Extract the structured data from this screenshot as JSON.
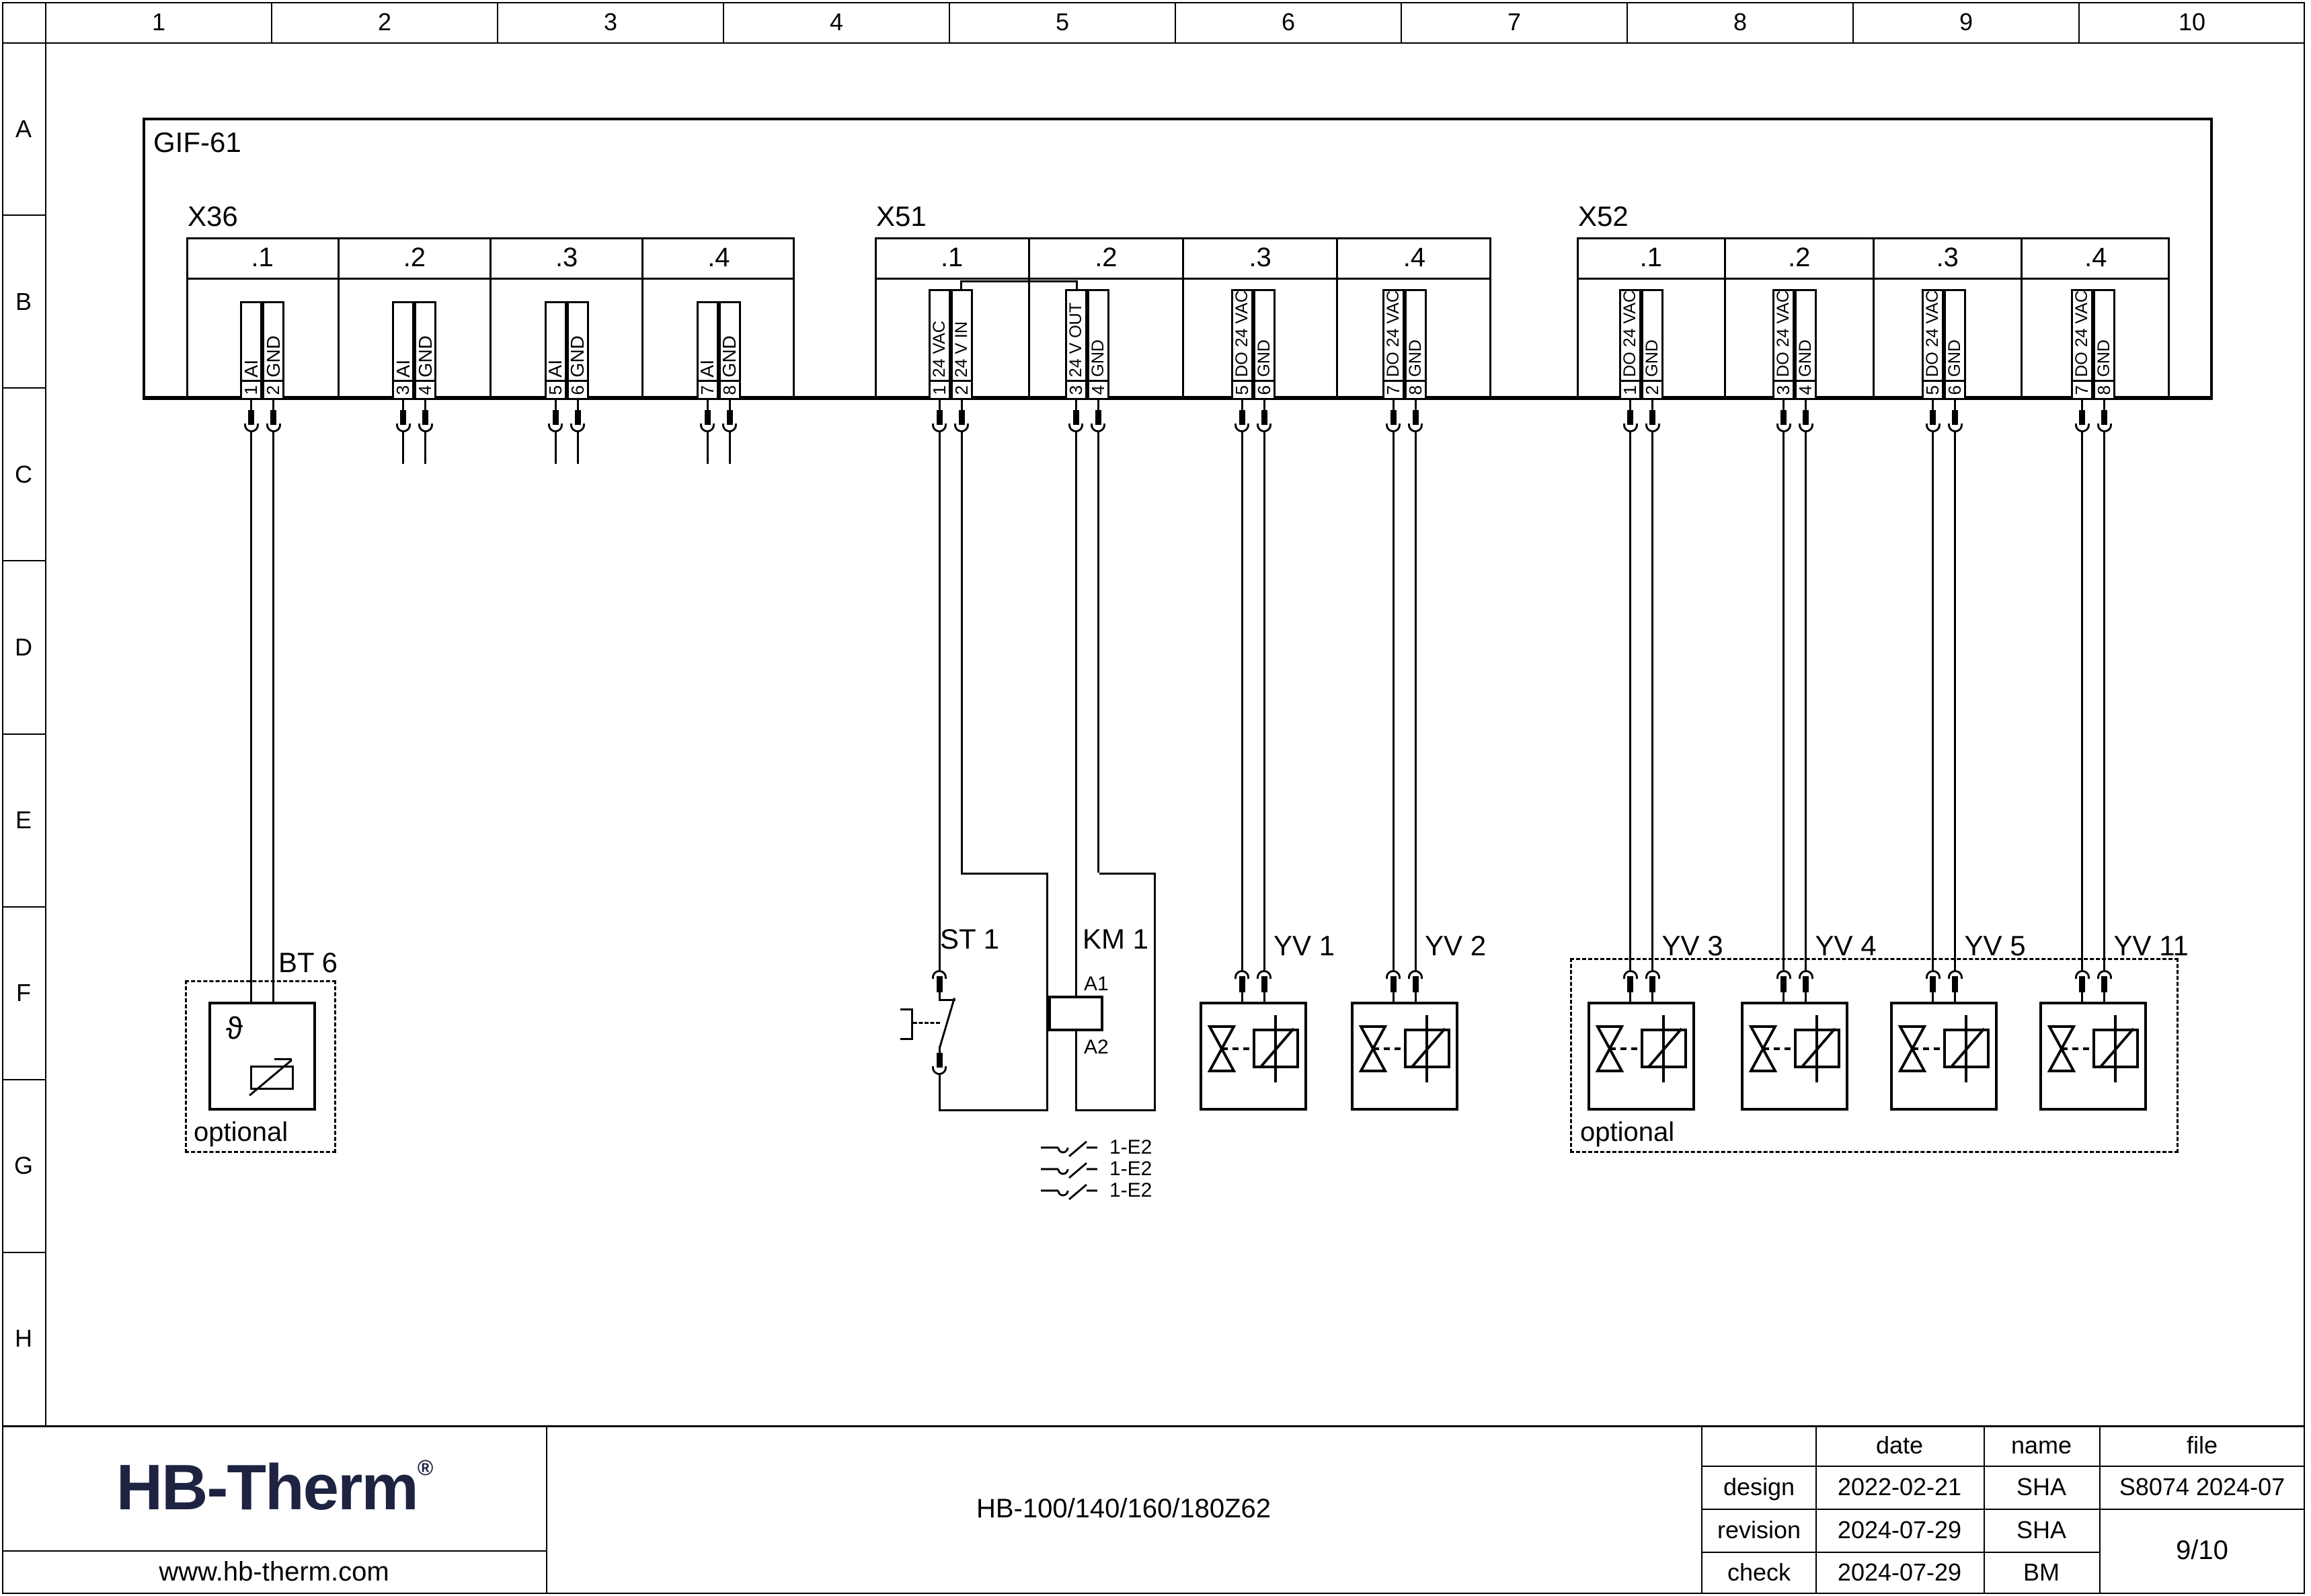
{
  "ruler": {
    "columns": [
      "1",
      "2",
      "3",
      "4",
      "5",
      "6",
      "7",
      "8",
      "9",
      "10"
    ],
    "rows": [
      "A",
      "B",
      "C",
      "D",
      "E",
      "F",
      "G",
      "H"
    ]
  },
  "module": {
    "label": "GIF-61"
  },
  "connectors": [
    {
      "label": "X36",
      "cells": [
        {
          "sub": ".1",
          "pins": [
            [
              "1",
              "AI"
            ],
            [
              "2",
              "GND"
            ]
          ]
        },
        {
          "sub": ".2",
          "pins": [
            [
              "3",
              "AI"
            ],
            [
              "4",
              "GND"
            ]
          ]
        },
        {
          "sub": ".3",
          "pins": [
            [
              "5",
              "AI"
            ],
            [
              "6",
              "GND"
            ]
          ]
        },
        {
          "sub": ".4",
          "pins": [
            [
              "7",
              "AI"
            ],
            [
              "8",
              "GND"
            ]
          ]
        }
      ]
    },
    {
      "label": "X51",
      "cells": [
        {
          "sub": ".1",
          "pins": [
            [
              "1",
              "24 VAC"
            ],
            [
              "2",
              "24 V IN"
            ]
          ]
        },
        {
          "sub": ".2",
          "pins": [
            [
              "3",
              "24 V OUT"
            ],
            [
              "4",
              "GND"
            ]
          ]
        },
        {
          "sub": ".3",
          "pins": [
            [
              "5",
              "DO 24 VAC"
            ],
            [
              "6",
              "GND"
            ]
          ]
        },
        {
          "sub": ".4",
          "pins": [
            [
              "7",
              "DO 24 VAC"
            ],
            [
              "8",
              "GND"
            ]
          ]
        }
      ]
    },
    {
      "label": "X52",
      "cells": [
        {
          "sub": ".1",
          "pins": [
            [
              "1",
              "DO 24 VAC"
            ],
            [
              "2",
              "GND"
            ]
          ]
        },
        {
          "sub": ".2",
          "pins": [
            [
              "3",
              "DO 24 VAC"
            ],
            [
              "4",
              "GND"
            ]
          ]
        },
        {
          "sub": ".3",
          "pins": [
            [
              "5",
              "DO 24 VAC"
            ],
            [
              "6",
              "GND"
            ]
          ]
        },
        {
          "sub": ".4",
          "pins": [
            [
              "7",
              "DO 24 VAC"
            ],
            [
              "8",
              "GND"
            ]
          ]
        }
      ]
    }
  ],
  "components": {
    "bt6": {
      "label": "BT 6",
      "symbol": "ϑ",
      "optional": "optional"
    },
    "st1": {
      "label": "ST 1"
    },
    "km1": {
      "label": "KM 1",
      "a1": "A1",
      "a2": "A2"
    },
    "km1_contacts": {
      "ref": "1-E2",
      "count": 3
    },
    "valves": [
      {
        "label": "YV 1"
      },
      {
        "label": "YV 2"
      },
      {
        "label": "YV 3"
      },
      {
        "label": "YV 4"
      },
      {
        "label": "YV 5"
      },
      {
        "label": "YV 11"
      }
    ],
    "optional_group": {
      "label": "optional"
    }
  },
  "titleblock": {
    "logo": "HB-Therm",
    "logo_reg": "®",
    "website": "www.hb-therm.com",
    "title": "HB-100/140/160/180Z62",
    "col_date": "date",
    "col_name": "name",
    "col_file": "file",
    "rows": [
      {
        "label": "design",
        "date": "2022-02-21",
        "name": "SHA"
      },
      {
        "label": "revision",
        "date": "2024-07-29",
        "name": "SHA"
      },
      {
        "label": "check",
        "date": "2024-07-29",
        "name": "BM"
      }
    ],
    "file_value": "S8074 2024-07",
    "page": "9/10"
  },
  "colors": {
    "line": "#000000",
    "logo": "#1e2342",
    "background": "#ffffff"
  }
}
